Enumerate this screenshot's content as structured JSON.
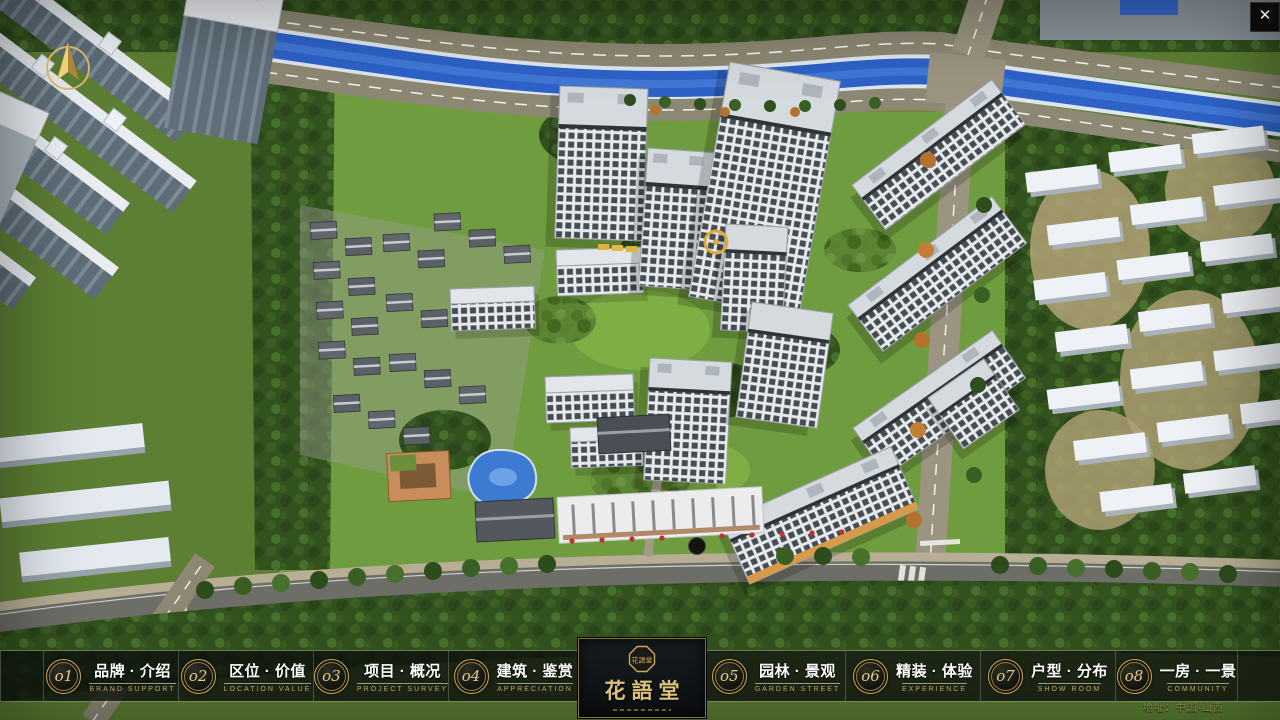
{
  "app": {
    "address": "地址：中国·山西",
    "close_glyph": "✕"
  },
  "logo": {
    "title": "花語堂",
    "emblem_chars": "花語堂"
  },
  "nav": {
    "items": [
      {
        "num": "o1",
        "title": "品牌 · 介绍",
        "subtitle": "BRAND SUPPORT"
      },
      {
        "num": "o2",
        "title": "区位 · 价值",
        "subtitle": "LOCATION VALUE"
      },
      {
        "num": "o3",
        "title": "项目 · 概况",
        "subtitle": "PROJECT SURVEY"
      },
      {
        "num": "o4",
        "title": "建筑 · 鉴赏",
        "subtitle": "APPRECIATION"
      },
      {
        "num": "o5",
        "title": "园林 · 景观",
        "subtitle": "GARDEN STREET"
      },
      {
        "num": "o6",
        "title": "精装 · 体验",
        "subtitle": "EXPERIENCE"
      },
      {
        "num": "o7",
        "title": "户型 · 分布",
        "subtitle": "SHOW ROOM"
      },
      {
        "num": "o8",
        "title": "一房 · 一景",
        "subtitle": "COMMUNITY"
      }
    ]
  },
  "colors": {
    "gold": "#c9a85c",
    "nav_bg": "rgba(13,16,13,0.8)",
    "river_blue": "#2e62c8",
    "accent_red": "#c23030"
  }
}
